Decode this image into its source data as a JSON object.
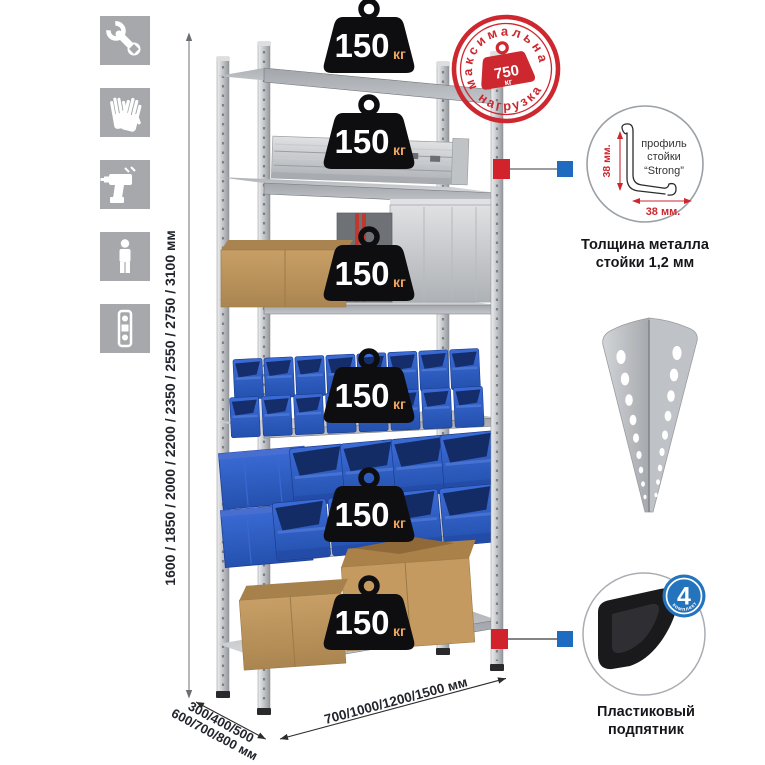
{
  "left_icons": [
    {
      "name": "wrench"
    },
    {
      "name": "gloves"
    },
    {
      "name": "drill"
    },
    {
      "name": "person"
    },
    {
      "name": "level"
    }
  ],
  "stamp": {
    "arc_top": "максимальная",
    "arc_bottom": "нагрузка",
    "weight_value": "750",
    "weight_unit": "кг"
  },
  "shelf_load": {
    "value": "150",
    "unit": "кг"
  },
  "dimensions": {
    "height": "1600 / 1850 / 2000 / 2200 / 2350 / 2550 / 2750 / 3100 мм",
    "depth_line1": "300/400/500",
    "depth_line2": "600/700/800 мм",
    "width": "700/1000/1200/1500 мм"
  },
  "profile_detail": {
    "line1": "профиль",
    "line2": "стойки",
    "line3": "“Strong”",
    "dim_vertical": "38 мм.",
    "dim_horizontal": "38 мм.",
    "caption1": "Толщина металла",
    "caption2": "стойки 1,2 мм"
  },
  "foot_detail": {
    "badge_number": "4",
    "badge_arc": "в комплекте",
    "caption1": "Пластиковый",
    "caption2": "подпятник"
  },
  "colors": {
    "stamp_red": "#cd2830",
    "accent_red": "#d2232c",
    "accent_blue": "#1e6bbf",
    "bin_blue": "#2c5ec8",
    "metal_gray": "#c6c9cd",
    "cardboard": "#c09a62",
    "icon_gray": "#a7a8ab"
  }
}
